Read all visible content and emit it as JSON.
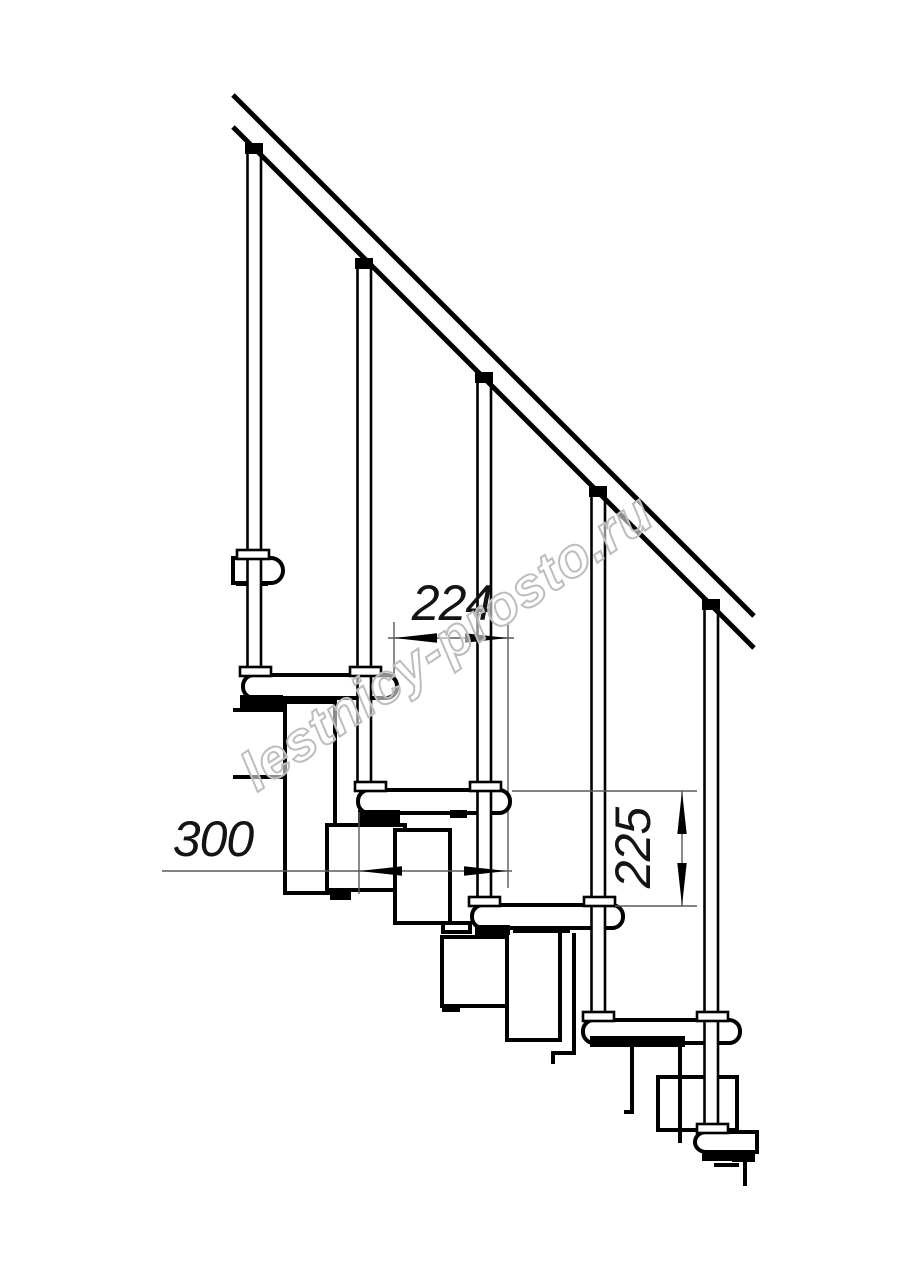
{
  "page": {
    "background": "#ffffff"
  },
  "drawing": {
    "title": "Modular staircase side elevation",
    "watermark_text": "lestnicy-prosto.ru",
    "line_color": "#000000",
    "dim_line_color": "#5a5a5a",
    "watermark_color": "#bdbdbd",
    "dimensions": {
      "run": {
        "label": "224"
      },
      "depth": {
        "label": "300"
      },
      "rise": {
        "label": "225"
      }
    }
  }
}
